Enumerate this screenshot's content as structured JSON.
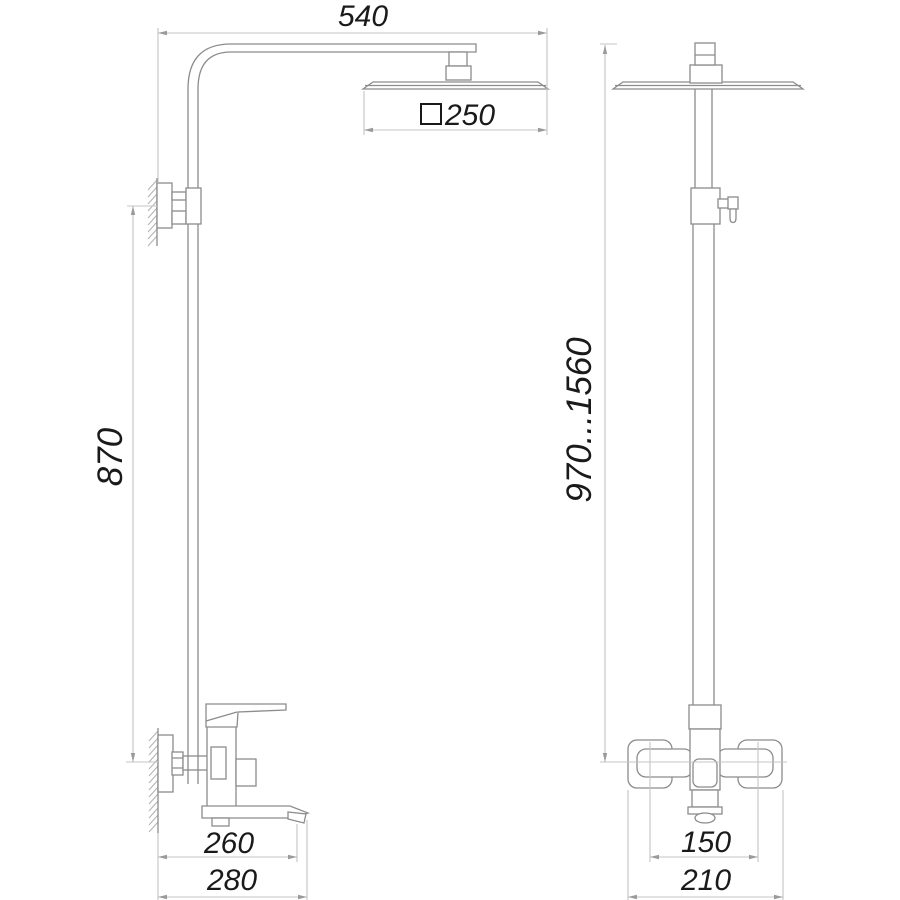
{
  "drawing": {
    "type": "shower-system-dimensional-drawing",
    "views": {
      "left": "side-view",
      "right": "front-view"
    }
  },
  "dimensions": {
    "arm_width": "540",
    "head_size": "250",
    "head_size_symbol": "square",
    "bracket_spacing": "870",
    "height_range": "970...1560",
    "spout_reach": "260",
    "total_depth": "280",
    "inlet_spacing": "150",
    "body_width": "210"
  },
  "colors": {
    "object_line": "#8c8c8c",
    "dimension_line": "#c4c4c4",
    "arrow": "#9a9a9a",
    "hatch_line": "#b2b2b2",
    "text": "#1a1a1a",
    "background": "#ffffff"
  }
}
